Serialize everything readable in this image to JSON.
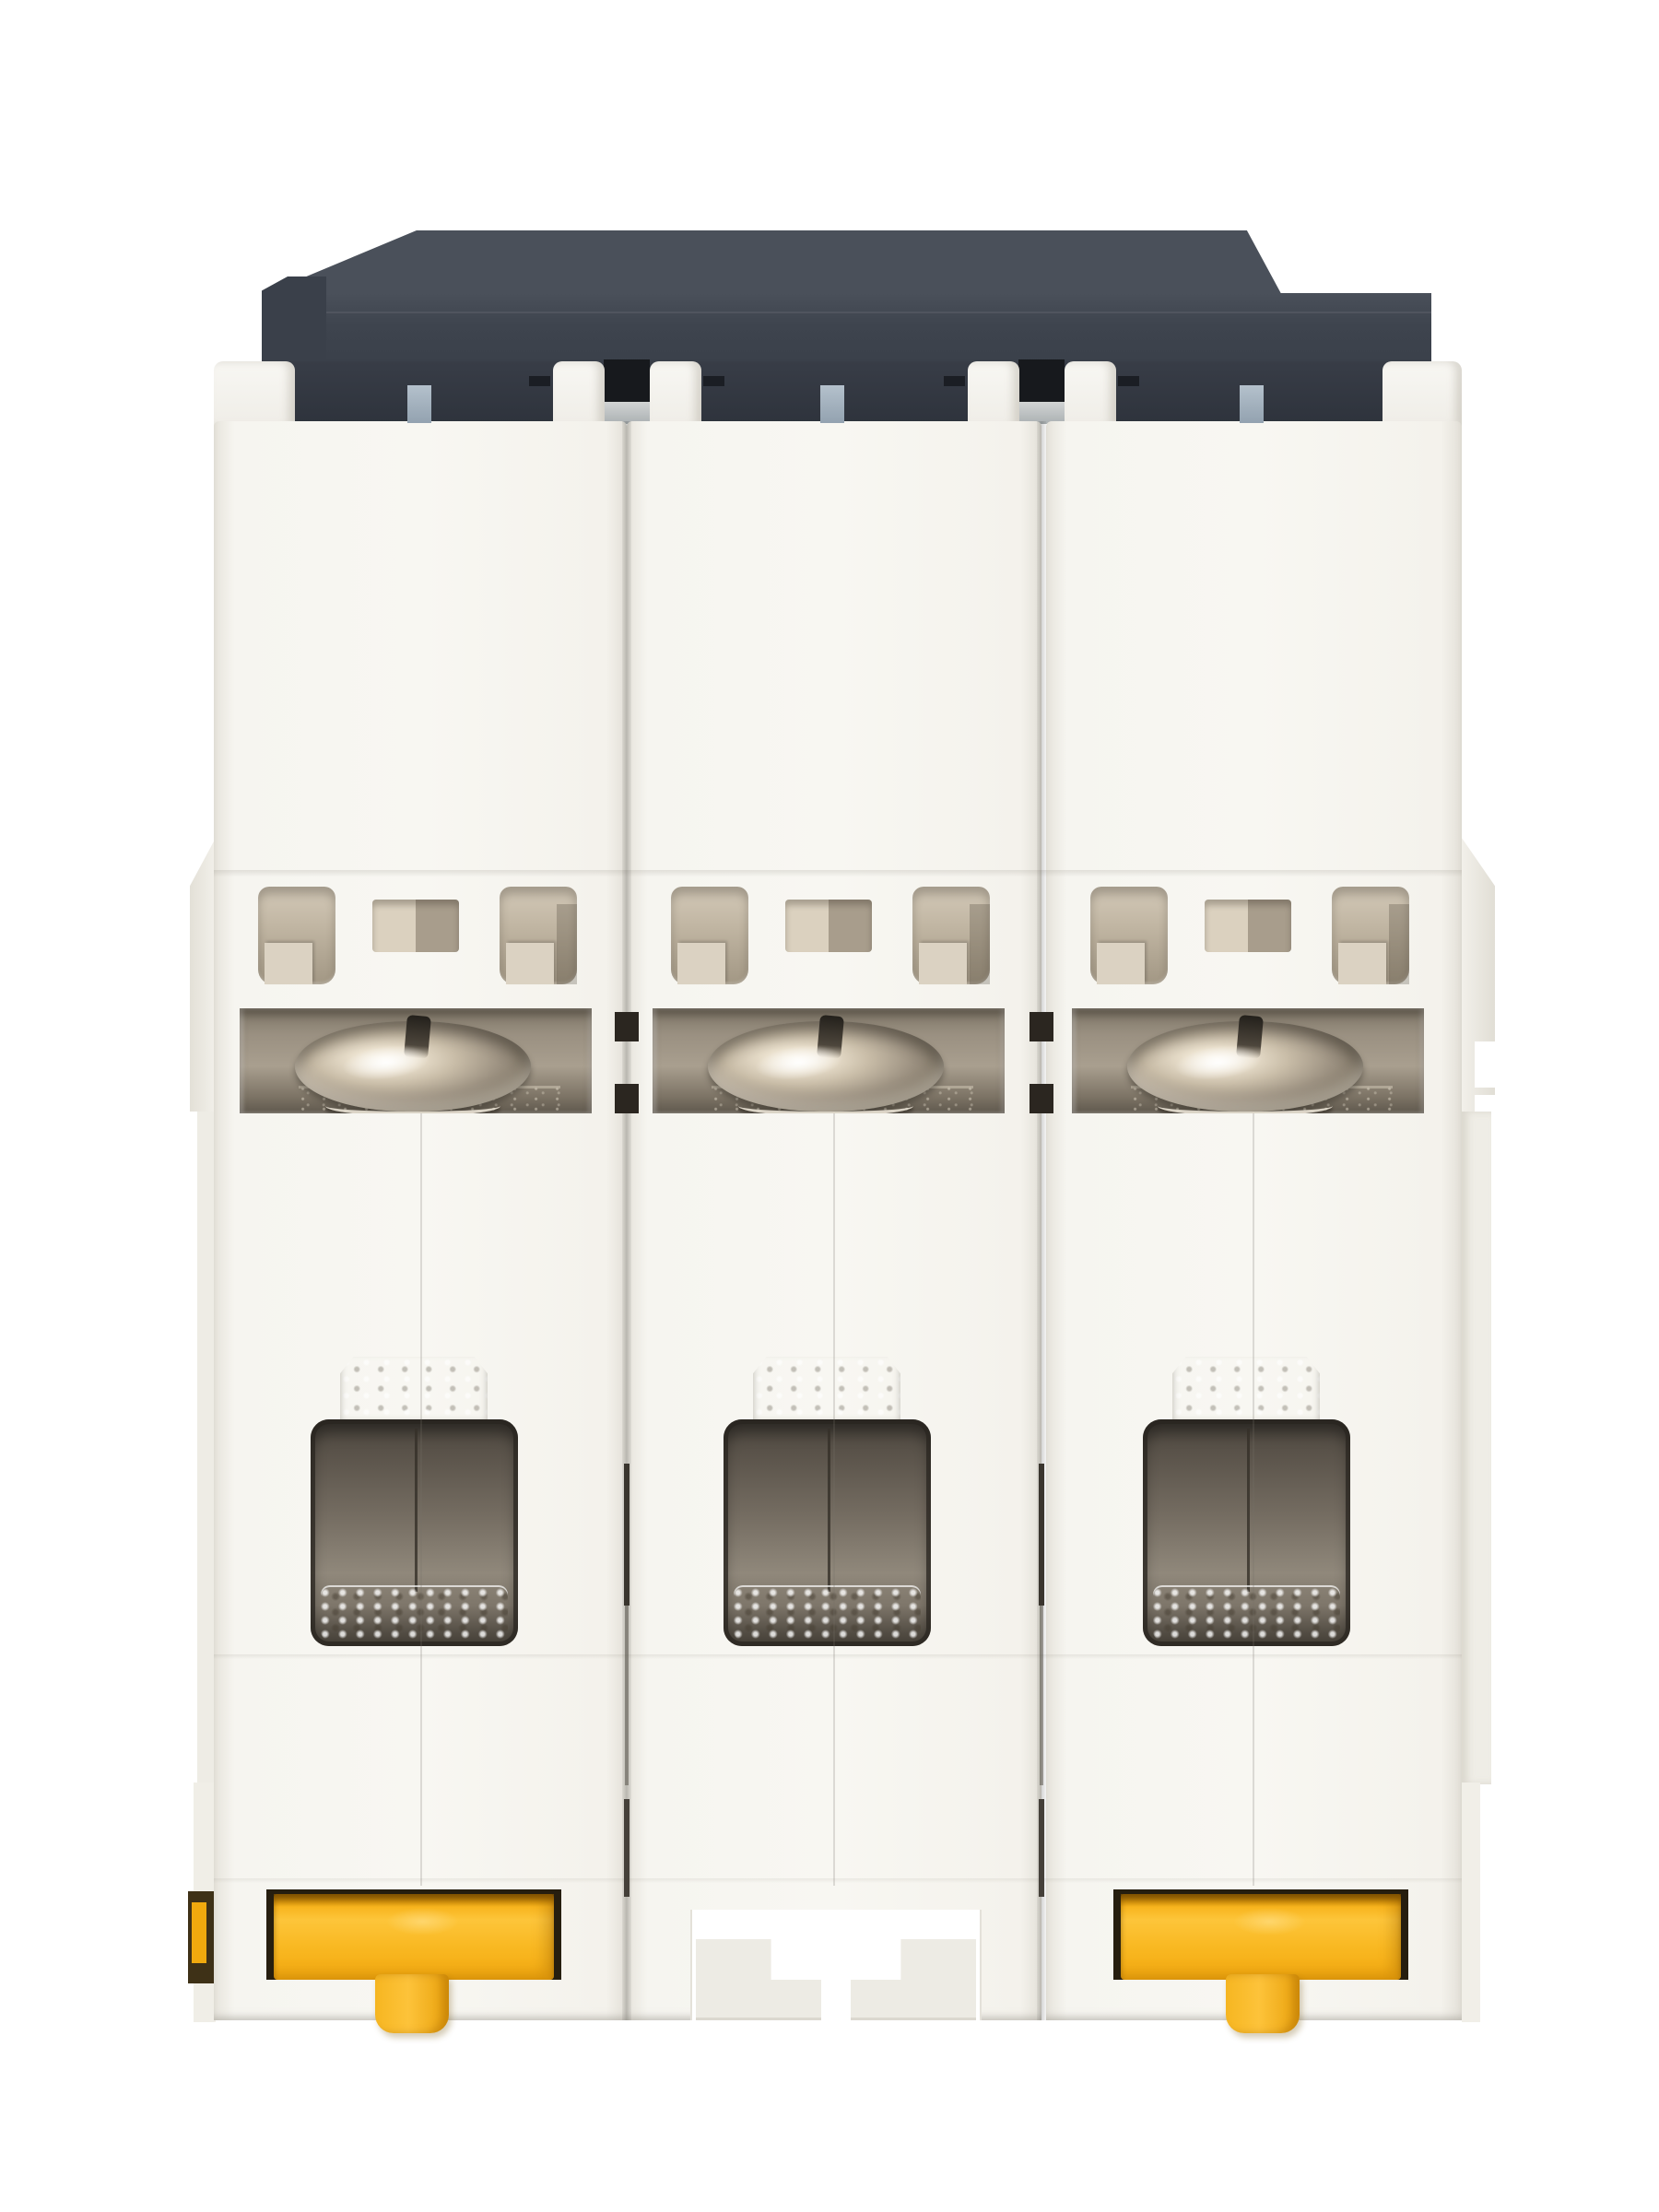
{
  "meta": {
    "alt": "Bottom view photograph of a white 3-pole DIN-rail miniature circuit breaker with dark gray top housing, three terminal screws, three wire terminal openings and two yellow DIN-rail clips",
    "background": "#ffffff"
  },
  "product": {
    "type": "miniature-circuit-breaker",
    "poles": 3,
    "view": "bottom-terminal-side",
    "counts": {
      "terminal_screws": 3,
      "wire_terminal_openings": 3,
      "ventilation_slots": 9,
      "din_rail_clips": 2,
      "din_rail_slots": 1
    }
  },
  "modules": [
    {
      "id": "pole-1",
      "din_clip": true,
      "din_slot": false,
      "clip_mirrored": false
    },
    {
      "id": "pole-2",
      "din_clip": false,
      "din_slot": true,
      "clip_mirrored": false
    },
    {
      "id": "pole-3",
      "din_clip": true,
      "din_slot": false,
      "clip_mirrored": true
    }
  ],
  "colors": {
    "background": "#ffffff",
    "plastic": "#f8f7f2",
    "cap": "#3e444e",
    "cap_light": "#4a505a",
    "cap_dark": "#2e333c",
    "slot_black": "#17191d",
    "blue_tab": "#93a2b0",
    "vent_light": "#d3c9b8",
    "vent_dark": "#a29784",
    "metal_light": "#fbf6ea",
    "metal_mid": "#c9bda8",
    "metal_dark": "#5a5246",
    "terminal_mid": "#90887b",
    "terminal_dark": "#3a342c",
    "yellow": "#f9b923",
    "yellow_dark": "#e9a10c",
    "recess_outline": "#261e0f"
  }
}
